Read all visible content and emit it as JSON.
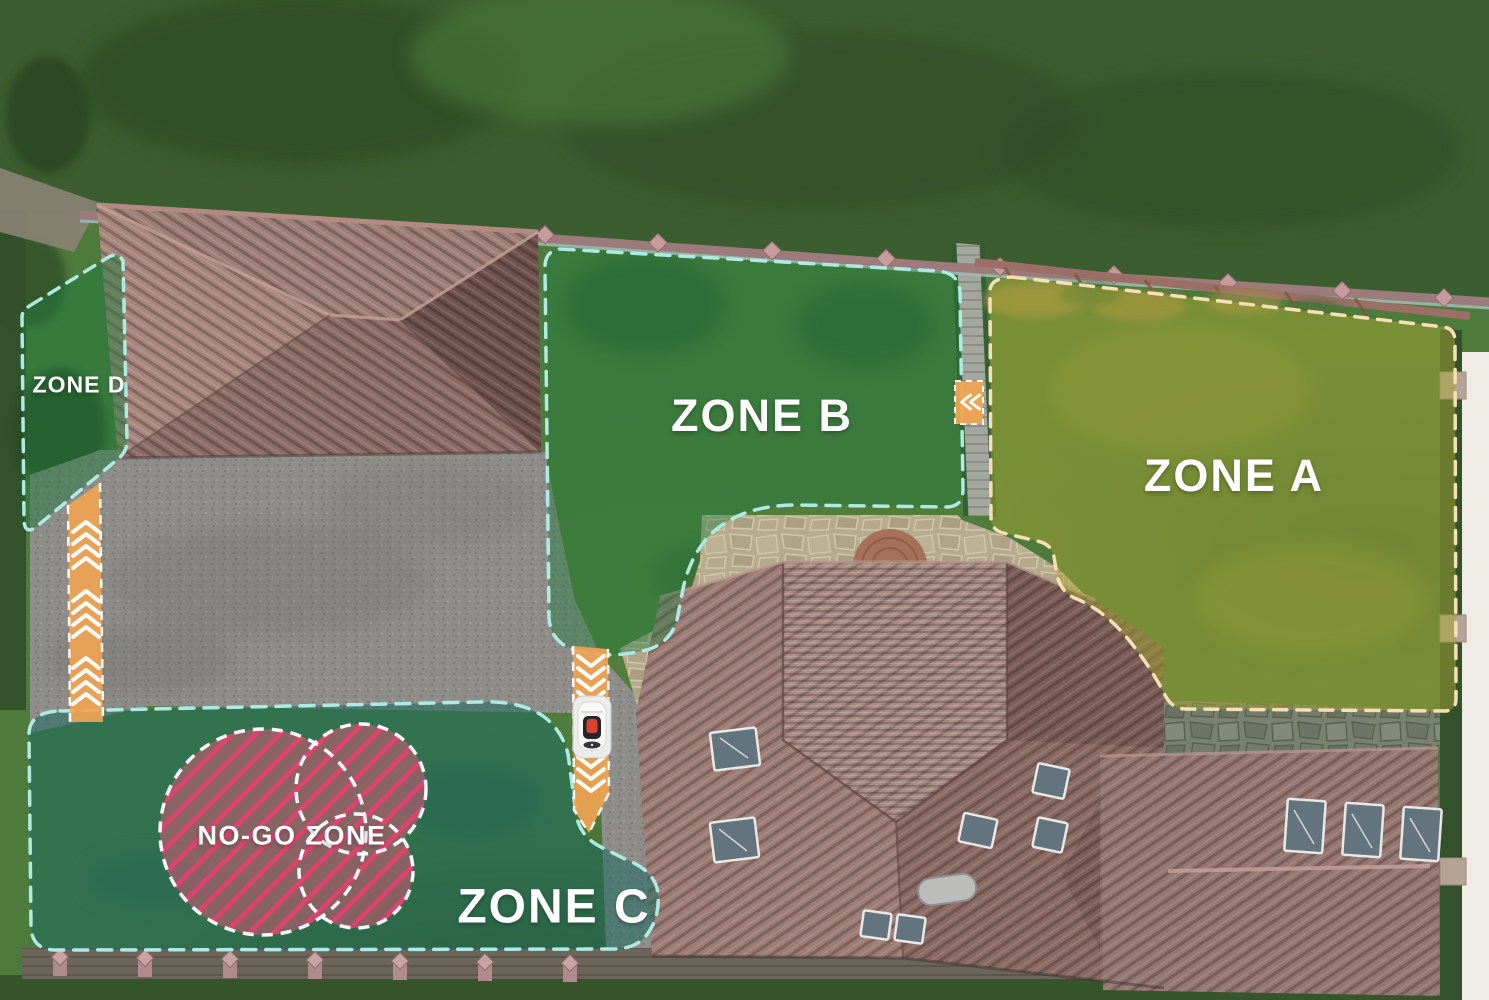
{
  "map": {
    "type": "aerial-property-zone-map",
    "zones": {
      "zone_a": {
        "label": "ZONE A",
        "overlay_color": "#a3a332",
        "border_color": "#f4e0b4",
        "border_style": "dashed"
      },
      "zone_b": {
        "label": "ZONE B",
        "overlay_color": "#1f7a3e",
        "border_color": "#aeeae2",
        "border_style": "dashed"
      },
      "zone_c": {
        "label": "ZONE C",
        "overlay_color": "#2a7a70",
        "border_color": "#aeeae2",
        "border_style": "dashed"
      },
      "zone_d": {
        "label": "ZONE D",
        "overlay_color": "#1f7a3e",
        "border_color": "#aeeae2",
        "border_style": "dashed"
      },
      "no_go": {
        "label": "NO-GO ZONE",
        "overlay_color": "#e2557a",
        "stripe_color": "#ee2f6d",
        "border_color": "#ffffff",
        "border_style": "dashed"
      }
    },
    "corridors": {
      "color": "#f0a452",
      "chevron_color": "#ffffff",
      "items": [
        {
          "name": "left-corridor",
          "direction": "up"
        },
        {
          "name": "center-corridor",
          "direction": "down"
        },
        {
          "name": "side-passage",
          "direction": "left"
        }
      ]
    },
    "robot_dock": {
      "name": "robotic-mower-on-dock",
      "body_color": "#f7f7f5",
      "button_color": "#d8402f"
    }
  }
}
